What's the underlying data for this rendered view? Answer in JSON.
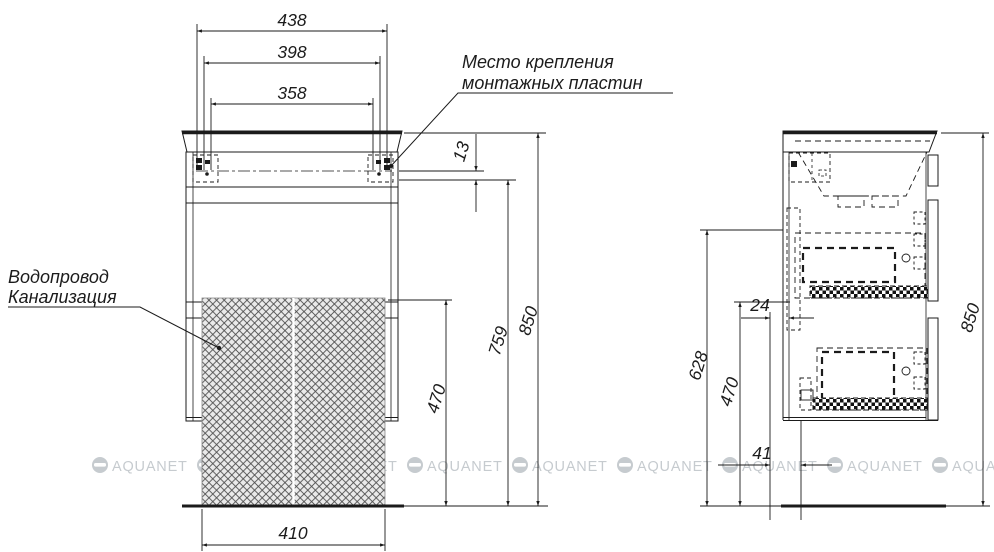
{
  "drawing": {
    "mounting_note": {
      "line1": "Место крепления",
      "line2": "монтажных пластин"
    },
    "plumbing_note": {
      "line1": "Водопровод",
      "line2": "Канализация"
    },
    "watermark": {
      "text": "AQUANET"
    },
    "dimensions": {
      "front": {
        "width_outer": "438",
        "width_mid": "398",
        "width_inner": "358",
        "plate_offset": "13",
        "height_mount": "759",
        "height_total": "850",
        "height_clearance": "470",
        "width_bottom": "410"
      },
      "side": {
        "back_gap": "24",
        "height_bottom_edge": "628",
        "height_clearance": "470",
        "bottom_gap": "41",
        "height_total": "850"
      }
    }
  }
}
